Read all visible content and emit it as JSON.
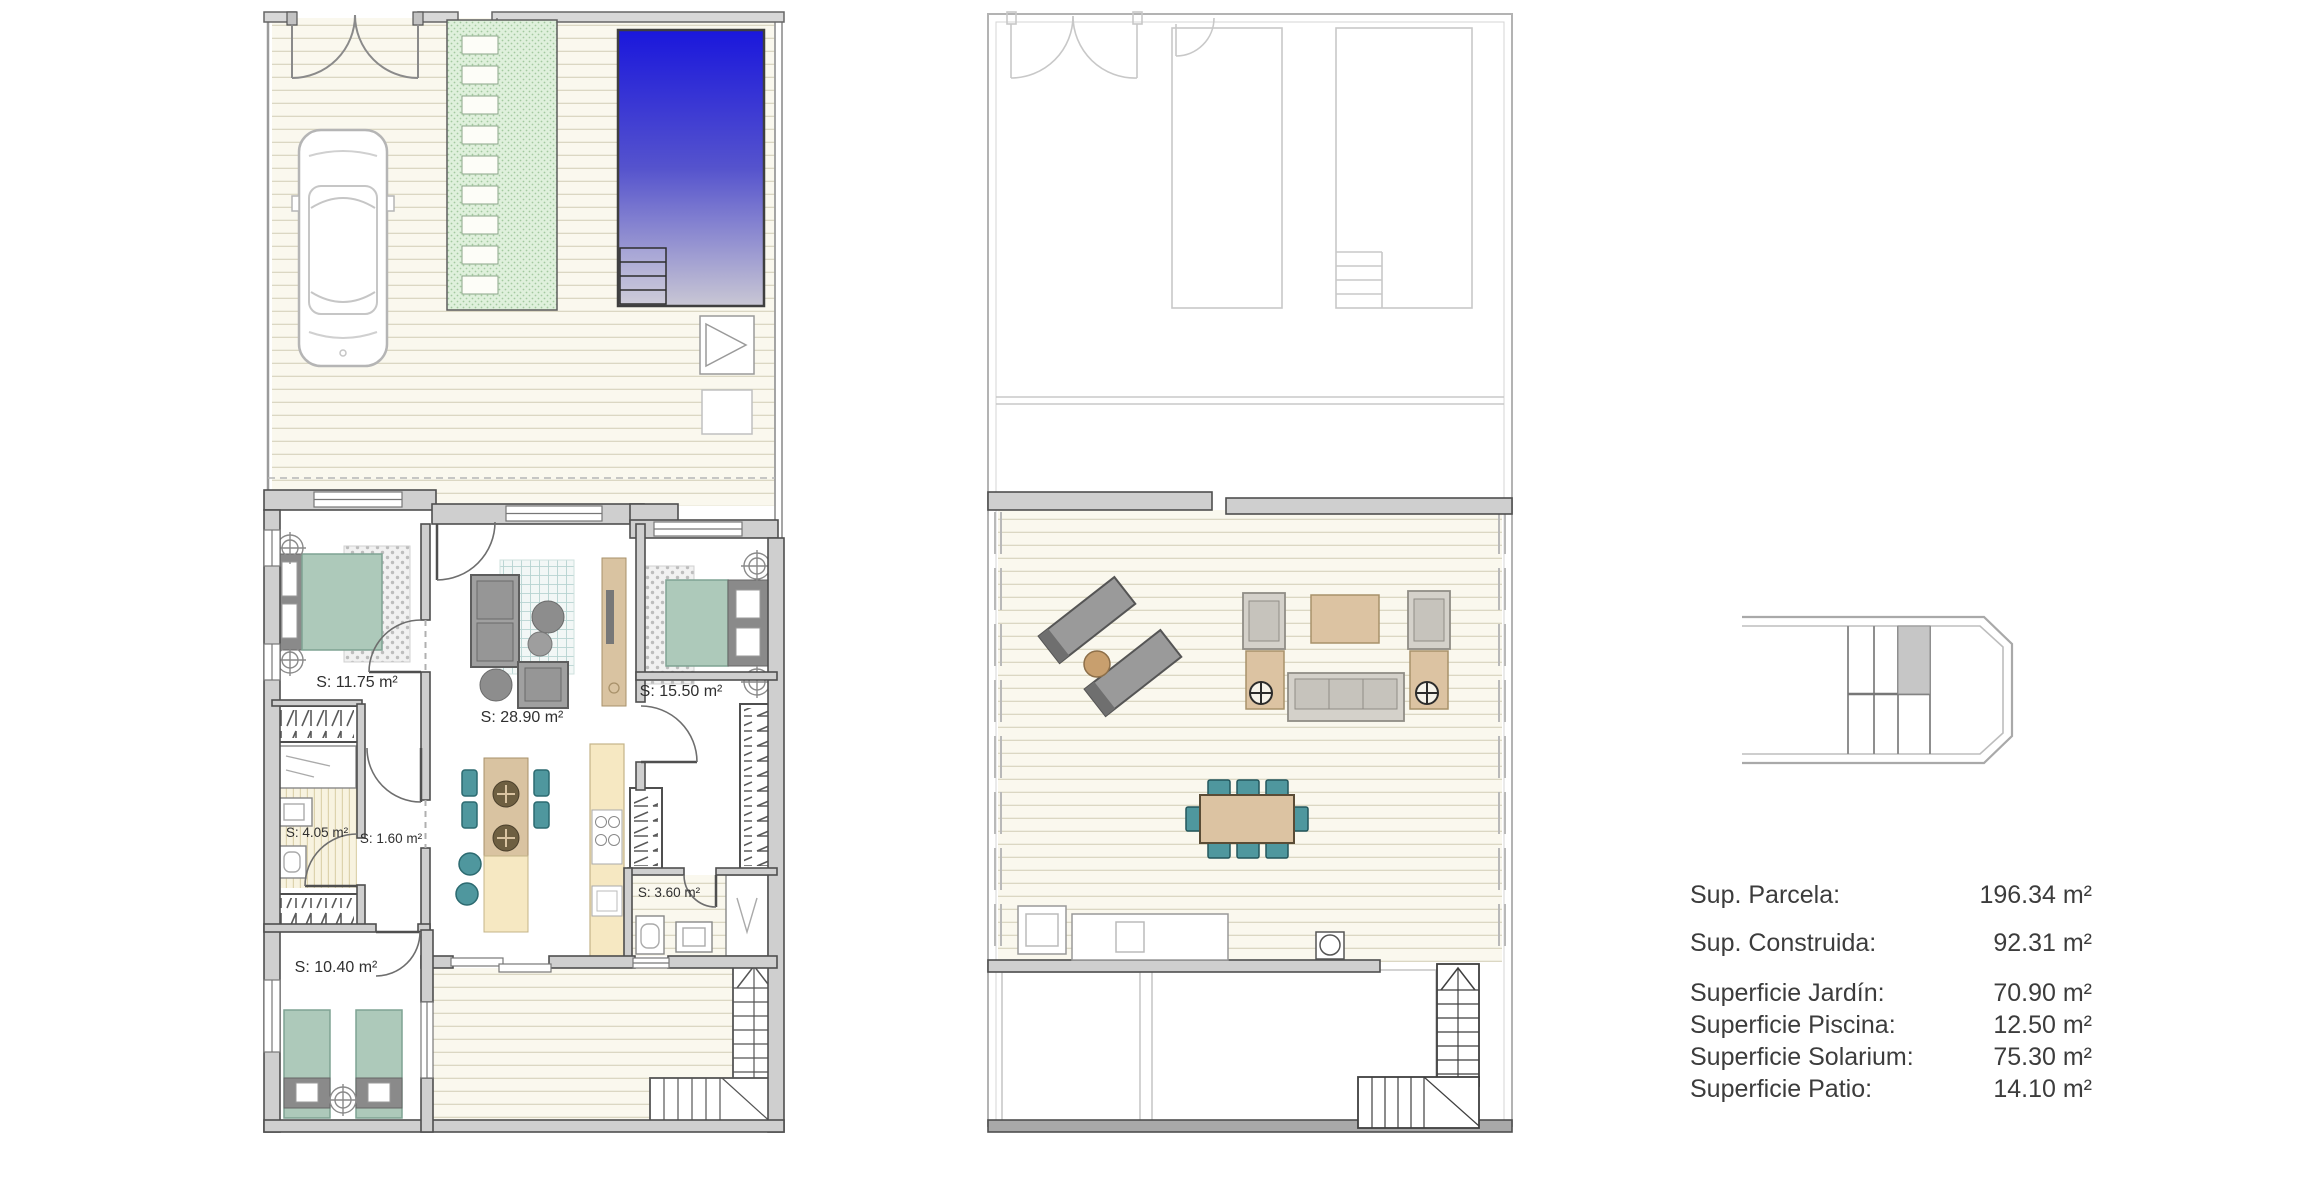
{
  "page": {
    "background": "#ffffff"
  },
  "plans": {
    "ground_floor": {
      "room_labels": [
        "S: 11.75 m²",
        "S: 28.90 m²",
        "S: 15.50 m²",
        "S: 4.05 m²",
        "S: 1.60 m²",
        "S: 3.60 m²",
        "S: 10.40 m²"
      ],
      "features": [
        "driveway",
        "car",
        "garden-strip",
        "swimming-pool",
        "pool-steps",
        "entrance-gate",
        "pedestrian-door",
        "patio",
        "staircase"
      ]
    },
    "first_floor": {
      "room_labels": [],
      "features": [
        "solarium-deck",
        "sun-loungers",
        "side-table",
        "lounge-set",
        "coffee-table",
        "dining-table",
        "outdoor-kitchen",
        "barbecue",
        "staircase"
      ]
    }
  },
  "key_plan": {
    "description": "row-of-units location strip with highlighted unit",
    "highlighted_unit_color": "#c6c6c6"
  },
  "legend": {
    "rows": [
      {
        "label": "Sup. Parcela:",
        "value": "196.34 m²"
      },
      {
        "label": "Sup. Construida:",
        "value": "92.31 m²"
      },
      {
        "label": "Superficie Jardín:",
        "value": "70.90 m²"
      },
      {
        "label": "Superficie Piscina:",
        "value": "12.50 m²"
      },
      {
        "label": "Superficie Solarium:",
        "value": "75.30 m²"
      },
      {
        "label": "Superficie Patio:",
        "value": "14.10 m²"
      }
    ]
  },
  "colors": {
    "pool_top": "#1a17dc",
    "pool_mid": "#5553cd",
    "pool_bottom": "#c9c7d4",
    "bed_green": "#adc9ba",
    "teal_chair": "#4f979e",
    "wood_tan": "#d9c3a1",
    "counter_cream": "#f6e8c2",
    "wall_gray": "#cfcfcf",
    "garden_green": "#dff0dc",
    "deck_background": "#faf8ee"
  }
}
